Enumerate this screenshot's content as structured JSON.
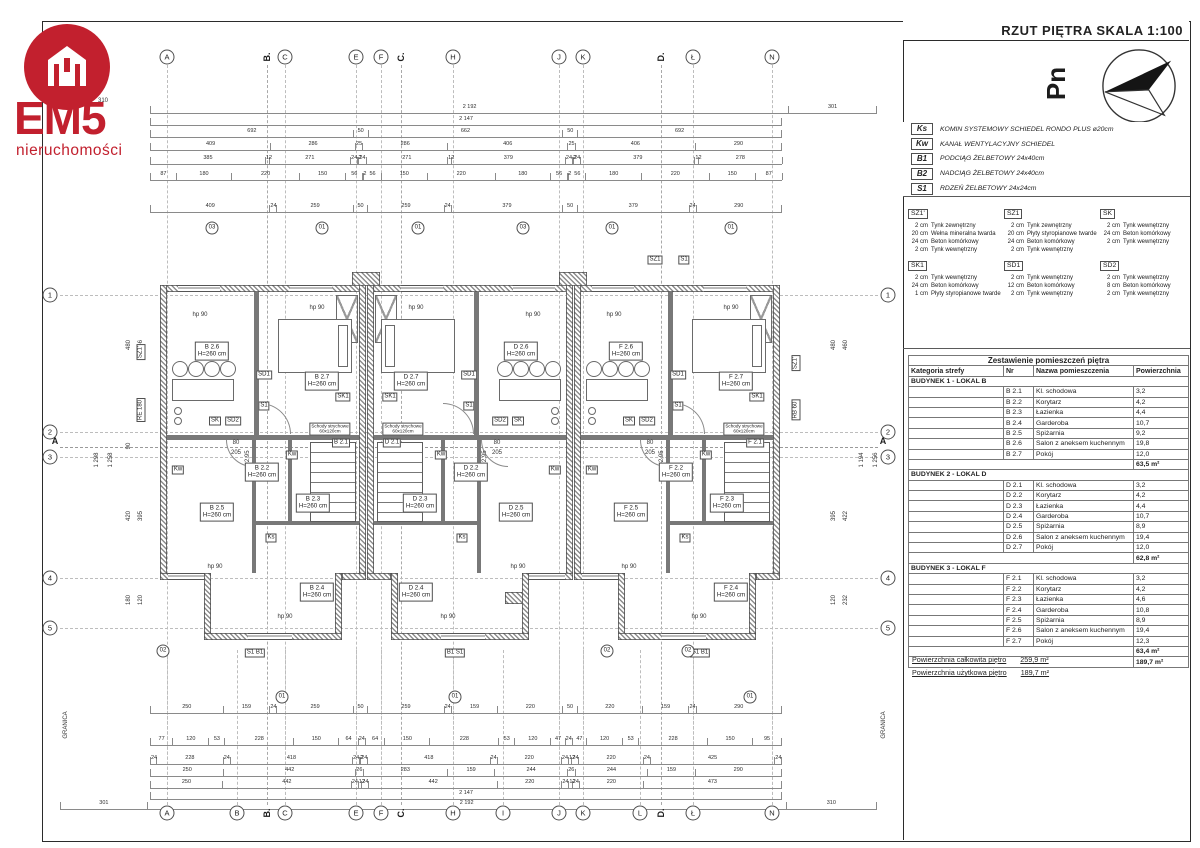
{
  "title": "RZUT PIĘTRA  SKALA 1:100",
  "logo": {
    "name": "EM5",
    "subtitle": "nieruchomości",
    "accent": "#c2202e"
  },
  "north_label": "Pn",
  "legend": [
    {
      "code": "Ks",
      "desc": "KOMIN SYSTEMOWY SCHIEDEL RONDO PLUS  ø20cm"
    },
    {
      "code": "Kw",
      "desc": "KANAŁ WENTYLACYJNY SCHIEDEL"
    },
    {
      "code": "B1",
      "desc": "PODCIĄG ŻELBETOWY 24x40cm"
    },
    {
      "code": "B2",
      "desc": "NADCIĄG ŻELBETOWY 24x40cm"
    },
    {
      "code": "S1",
      "desc": "RDZEŃ ŻELBETOWY 24x24cm"
    }
  ],
  "wall_types": [
    {
      "code": "SZ1'",
      "layers": [
        [
          "2 cm",
          "Tynk zewnętrzny"
        ],
        [
          "20 cm",
          "Wełna mineralna twarda"
        ],
        [
          "24 cm",
          "Beton komórkowy"
        ],
        [
          "2 cm",
          "Tynk wewnętrzny"
        ]
      ]
    },
    {
      "code": "SZ1",
      "layers": [
        [
          "2 cm",
          "Tynk zewnętrzny"
        ],
        [
          "20 cm",
          "Płyty styropianowe twarde"
        ],
        [
          "24 cm",
          "Beton komórkowy"
        ],
        [
          "2 cm",
          "Tynk wewnętrzny"
        ]
      ]
    },
    {
      "code": "SK",
      "layers": [
        [
          "2 cm",
          "Tynk wewnętrzny"
        ],
        [
          "24 cm",
          "Beton komórkowy"
        ],
        [
          "2 cm",
          "Tynk wewnętrzny"
        ]
      ]
    },
    {
      "code": "SK1",
      "layers": [
        [
          "2 cm",
          "Tynk wewnętrzny"
        ],
        [
          "24 cm",
          "Beton komórkowy"
        ],
        [
          "1 cm",
          "Płyty styropianowe twarde"
        ]
      ]
    },
    {
      "code": "SD1",
      "layers": [
        [
          "2 cm",
          "Tynk wewnętrzny"
        ],
        [
          "12 cm",
          "Beton komórkowy"
        ],
        [
          "2 cm",
          "Tynk wewnętrzny"
        ]
      ]
    },
    {
      "code": "SD2",
      "layers": [
        [
          "2 cm",
          "Tynk wewnętrzny"
        ],
        [
          "8 cm",
          "Beton komórkowy"
        ],
        [
          "2 cm",
          "Tynk wewnętrzny"
        ]
      ]
    }
  ],
  "schedule": {
    "title": "Zestawienie pomieszczeń piętra",
    "columns": [
      "Kategoria strefy",
      "Nr",
      "Nazwa pomieszczenia",
      "Powierzchnia"
    ],
    "sections": [
      {
        "header": "BUDYNEK 1 - LOKAL B",
        "rows": [
          [
            "B 2.1",
            "Kl. schodowa",
            "3,2"
          ],
          [
            "B 2.2",
            "Korytarz",
            "4,2"
          ],
          [
            "B 2.3",
            "Łazienka",
            "4,4"
          ],
          [
            "B 2.4",
            "Garderoba",
            "10,7"
          ],
          [
            "B 2.5",
            "Spiżarnia",
            "9,2"
          ],
          [
            "B 2.6",
            "Salon z aneksem kuchennym",
            "19,8"
          ],
          [
            "B 2.7",
            "Pokój",
            "12,0"
          ]
        ],
        "total": "63,5 m²"
      },
      {
        "header": "BUDYNEK 2 - LOKAL D",
        "rows": [
          [
            "D 2.1",
            "Kl. schodowa",
            "3,2"
          ],
          [
            "D 2.2",
            "Korytarz",
            "4,2"
          ],
          [
            "D 2.3",
            "Łazienka",
            "4,4"
          ],
          [
            "D 2.4",
            "Garderoba",
            "10,7"
          ],
          [
            "D 2.5",
            "Spiżarnia",
            "8,9"
          ],
          [
            "D 2.6",
            "Salon z aneksem kuchennym",
            "19,4"
          ],
          [
            "D 2.7",
            "Pokój",
            "12,0"
          ]
        ],
        "total": "62,8 m²"
      },
      {
        "header": "BUDYNEK 3 - LOKAL F",
        "rows": [
          [
            "F 2.1",
            "Kl. schodowa",
            "3,2"
          ],
          [
            "F 2.2",
            "Korytarz",
            "4,2"
          ],
          [
            "F 2.3",
            "Łazienka",
            "4,6"
          ],
          [
            "F 2.4",
            "Garderoba",
            "10,8"
          ],
          [
            "F 2.5",
            "Spiżarnia",
            "8,9"
          ],
          [
            "F 2.6",
            "Salon z aneksem kuchennym",
            "19,4"
          ],
          [
            "F 2.7",
            "Pokój",
            "12,3"
          ]
        ],
        "total": "63,4 m²"
      }
    ],
    "grand_total": "189,7 m²"
  },
  "totals": [
    {
      "label": "Powierzchnia całkowita piętro",
      "value": "259,9 m²"
    },
    {
      "label": "Powierzchnia użytkowa piętro",
      "value": "189,7 m²"
    }
  ],
  "plan": {
    "h_text": "H=260 cm",
    "hp_text": "hp 90",
    "attic_stairs": [
      "Schody strychowe",
      "60x120cm"
    ],
    "door_w": "80",
    "door_h": "205",
    "level": "+2,95",
    "granica": "GRANICA",
    "axes_top": [
      {
        "l": "A",
        "x": 167
      },
      {
        "l": "B",
        "x": 267,
        "sec": true
      },
      {
        "l": "C",
        "x": 285
      },
      {
        "l": "E",
        "x": 356
      },
      {
        "l": "F",
        "x": 381
      },
      {
        "l": "C",
        "x": 401,
        "sec": true
      },
      {
        "l": "H",
        "x": 453
      },
      {
        "l": "J",
        "x": 559
      },
      {
        "l": "K",
        "x": 583
      },
      {
        "l": "D",
        "x": 661,
        "sec": true
      },
      {
        "l": "Ł",
        "x": 693
      },
      {
        "l": "N",
        "x": 772
      }
    ],
    "axes_bottom": [
      {
        "l": "A",
        "x": 167
      },
      {
        "l": "B",
        "x": 237
      },
      {
        "l": "B",
        "x": 267,
        "sec": true
      },
      {
        "l": "C",
        "x": 285
      },
      {
        "l": "E",
        "x": 356
      },
      {
        "l": "F",
        "x": 381
      },
      {
        "l": "C",
        "x": 401,
        "sec": true
      },
      {
        "l": "H",
        "x": 453
      },
      {
        "l": "I",
        "x": 503
      },
      {
        "l": "J",
        "x": 559
      },
      {
        "l": "K",
        "x": 583
      },
      {
        "l": "L",
        "x": 640
      },
      {
        "l": "D",
        "x": 661,
        "sec": true
      },
      {
        "l": "Ł",
        "x": 693
      },
      {
        "l": "N",
        "x": 772
      }
    ],
    "axes_left": [
      {
        "l": "1",
        "y": 295
      },
      {
        "l": "2",
        "y": 432
      },
      {
        "l": "3",
        "y": 457
      },
      {
        "l": "4",
        "y": 578
      },
      {
        "l": "5",
        "y": 628
      }
    ],
    "axes_right": [
      {
        "l": "1",
        "y": 295
      },
      {
        "l": "2",
        "y": 432
      },
      {
        "l": "3",
        "y": 457
      },
      {
        "l": "4",
        "y": 578
      },
      {
        "l": "5",
        "y": 628
      }
    ],
    "section_a": "A",
    "dims_top": [
      {
        "y": 106,
        "x1": 150,
        "x2": 877,
        "v": [
          "2 192",
          "301"
        ]
      },
      {
        "y": 118,
        "x1": 150,
        "x2": 782,
        "v": [
          "2 147"
        ]
      },
      {
        "y": 130,
        "x1": 150,
        "x2": 782,
        "v": [
          "692",
          "50",
          "662",
          "50",
          "692"
        ]
      },
      {
        "y": 143,
        "x1": 150,
        "x2": 782,
        "v": [
          "409",
          "286",
          "25",
          "286",
          "406",
          "25",
          "406",
          "290"
        ]
      },
      {
        "y": 157,
        "x1": 150,
        "x2": 782,
        "v": [
          "385",
          "12",
          "271",
          "24",
          "2",
          "24",
          "271",
          "12",
          "379",
          "24",
          "2",
          "24",
          "379",
          "12",
          "278"
        ]
      },
      {
        "y": 173,
        "x1": 150,
        "x2": 782,
        "v": [
          "87",
          "180",
          "220",
          "150",
          "56",
          "2",
          "56",
          "150",
          "220",
          "180",
          "56",
          "2",
          "56",
          "180",
          "220",
          "150",
          "87"
        ]
      },
      {
        "y": 205,
        "x1": 150,
        "x2": 782,
        "v": [
          "409",
          "24",
          "259",
          "50",
          "259",
          "24",
          "379",
          "50",
          "379",
          "24",
          "290"
        ]
      }
    ],
    "dims_bottom": [
      {
        "y": 706,
        "x1": 150,
        "x2": 782,
        "v": [
          "250",
          "159",
          "24",
          "259",
          "50",
          "259",
          "24",
          "159",
          "220",
          "50",
          "220",
          "159",
          "24",
          "290"
        ]
      },
      {
        "y": 738,
        "x1": 150,
        "x2": 782,
        "v": [
          "77",
          "120",
          "53",
          "228",
          "150",
          "64",
          "24",
          "64",
          "150",
          "228",
          "53",
          "120",
          "47",
          "24",
          "47",
          "120",
          "53",
          "228",
          "150",
          "95"
        ]
      },
      {
        "y": 757,
        "x1": 150,
        "x2": 782,
        "v": [
          "24",
          "228",
          "24",
          "418",
          "24",
          "2",
          "24",
          "418",
          "24",
          "220",
          "24",
          "12",
          "24",
          "220",
          "24",
          "425",
          "24"
        ]
      },
      {
        "y": 769,
        "x1": 150,
        "x2": 782,
        "v": [
          "250",
          "442",
          "26",
          "283",
          "159",
          "244",
          "26",
          "244",
          "159",
          "290"
        ]
      },
      {
        "y": 781,
        "x1": 150,
        "x2": 782,
        "v": [
          "250",
          "442",
          "24",
          "12",
          "24",
          "442",
          "220",
          "24",
          "12",
          "24",
          "220",
          "473"
        ]
      },
      {
        "y": 792,
        "x1": 150,
        "x2": 782,
        "v": [
          "2 147"
        ]
      },
      {
        "y": 802,
        "x1": 60,
        "x2": 877,
        "v": [
          "301",
          "2 192",
          "310"
        ]
      }
    ],
    "side_labels": [
      {
        "t": "310",
        "x": 103,
        "y": 101,
        "rot": false
      },
      {
        "t": "1 298",
        "x": 97,
        "y": 460,
        "rot": true
      },
      {
        "t": "1 258",
        "x": 111,
        "y": 460,
        "rot": true
      },
      {
        "t": "480",
        "x": 129,
        "y": 345,
        "rot": true
      },
      {
        "t": "546",
        "x": 141,
        "y": 345,
        "rot": true
      },
      {
        "t": "90",
        "x": 129,
        "y": 446,
        "rot": true
      },
      {
        "t": "420",
        "x": 129,
        "y": 516,
        "rot": true
      },
      {
        "t": "395",
        "x": 141,
        "y": 516,
        "rot": true
      },
      {
        "t": "180",
        "x": 129,
        "y": 600,
        "rot": true
      },
      {
        "t": "120",
        "x": 141,
        "y": 600,
        "rot": true
      },
      {
        "t": "1 194",
        "x": 862,
        "y": 460,
        "rot": true
      },
      {
        "t": "1 256",
        "x": 876,
        "y": 460,
        "rot": true
      },
      {
        "t": "460",
        "x": 846,
        "y": 345,
        "rot": true
      },
      {
        "t": "480",
        "x": 834,
        "y": 345,
        "rot": true
      },
      {
        "t": "422",
        "x": 846,
        "y": 516,
        "rot": true
      },
      {
        "t": "395",
        "x": 834,
        "y": 516,
        "rot": true
      },
      {
        "t": "232",
        "x": 846,
        "y": 600,
        "rot": true
      },
      {
        "t": "120",
        "x": 834,
        "y": 600,
        "rot": true
      },
      {
        "t": "GRANICA",
        "x": 66,
        "y": 725,
        "rot": true
      },
      {
        "t": "GRANICA",
        "x": 884,
        "y": 725,
        "rot": true
      }
    ],
    "wall_chips": [
      {
        "t": "SZ1",
        "x": 655,
        "y": 260,
        "rot": false
      },
      {
        "t": "S1",
        "x": 684,
        "y": 260,
        "rot": false
      },
      {
        "t": "SZ1'",
        "x": 141,
        "y": 352,
        "rot": true
      },
      {
        "t": "RE 180",
        "x": 141,
        "y": 410,
        "rot": true
      },
      {
        "t": "SZ1'",
        "x": 796,
        "y": 363,
        "rot": true
      },
      {
        "t": "RB 60",
        "x": 796,
        "y": 410,
        "rot": true
      },
      {
        "t": "S1 B1",
        "x": 255,
        "y": 653,
        "rot": false
      },
      {
        "t": "B1 S1",
        "x": 455,
        "y": 653,
        "rot": false
      },
      {
        "t": "S1 B1",
        "x": 700,
        "y": 653,
        "rot": false
      }
    ],
    "detail_marks": [
      {
        "t": "03",
        "x": 212,
        "y": 228
      },
      {
        "t": "01",
        "x": 322,
        "y": 228
      },
      {
        "t": "01",
        "x": 418,
        "y": 228
      },
      {
        "t": "03",
        "x": 523,
        "y": 228
      },
      {
        "t": "01",
        "x": 612,
        "y": 228
      },
      {
        "t": "01",
        "x": 731,
        "y": 228
      },
      {
        "t": "02",
        "x": 163,
        "y": 651
      },
      {
        "t": "02",
        "x": 607,
        "y": 651
      },
      {
        "t": "02",
        "x": 688,
        "y": 651
      },
      {
        "t": "01",
        "x": 282,
        "y": 697
      },
      {
        "t": "01",
        "x": 455,
        "y": 697
      },
      {
        "t": "01",
        "x": 750,
        "y": 697
      }
    ],
    "units": [
      {
        "prefix": "B",
        "x": 160,
        "mirror": false
      },
      {
        "prefix": "D",
        "x": 367,
        "mirror": true
      },
      {
        "prefix": "F",
        "x": 574,
        "mirror": false
      }
    ],
    "room_nos": {
      "salon": "2.6",
      "pokoj": "2.7",
      "korytarz": "2.2",
      "lazienka": "2.3",
      "garderoba": "2.4",
      "spizarnia": "2.5",
      "schody": "2.1"
    },
    "unit_chips": [
      "SD1",
      "S1",
      "SK",
      "SD2",
      "SK1",
      "Kw",
      "Ks"
    ]
  }
}
